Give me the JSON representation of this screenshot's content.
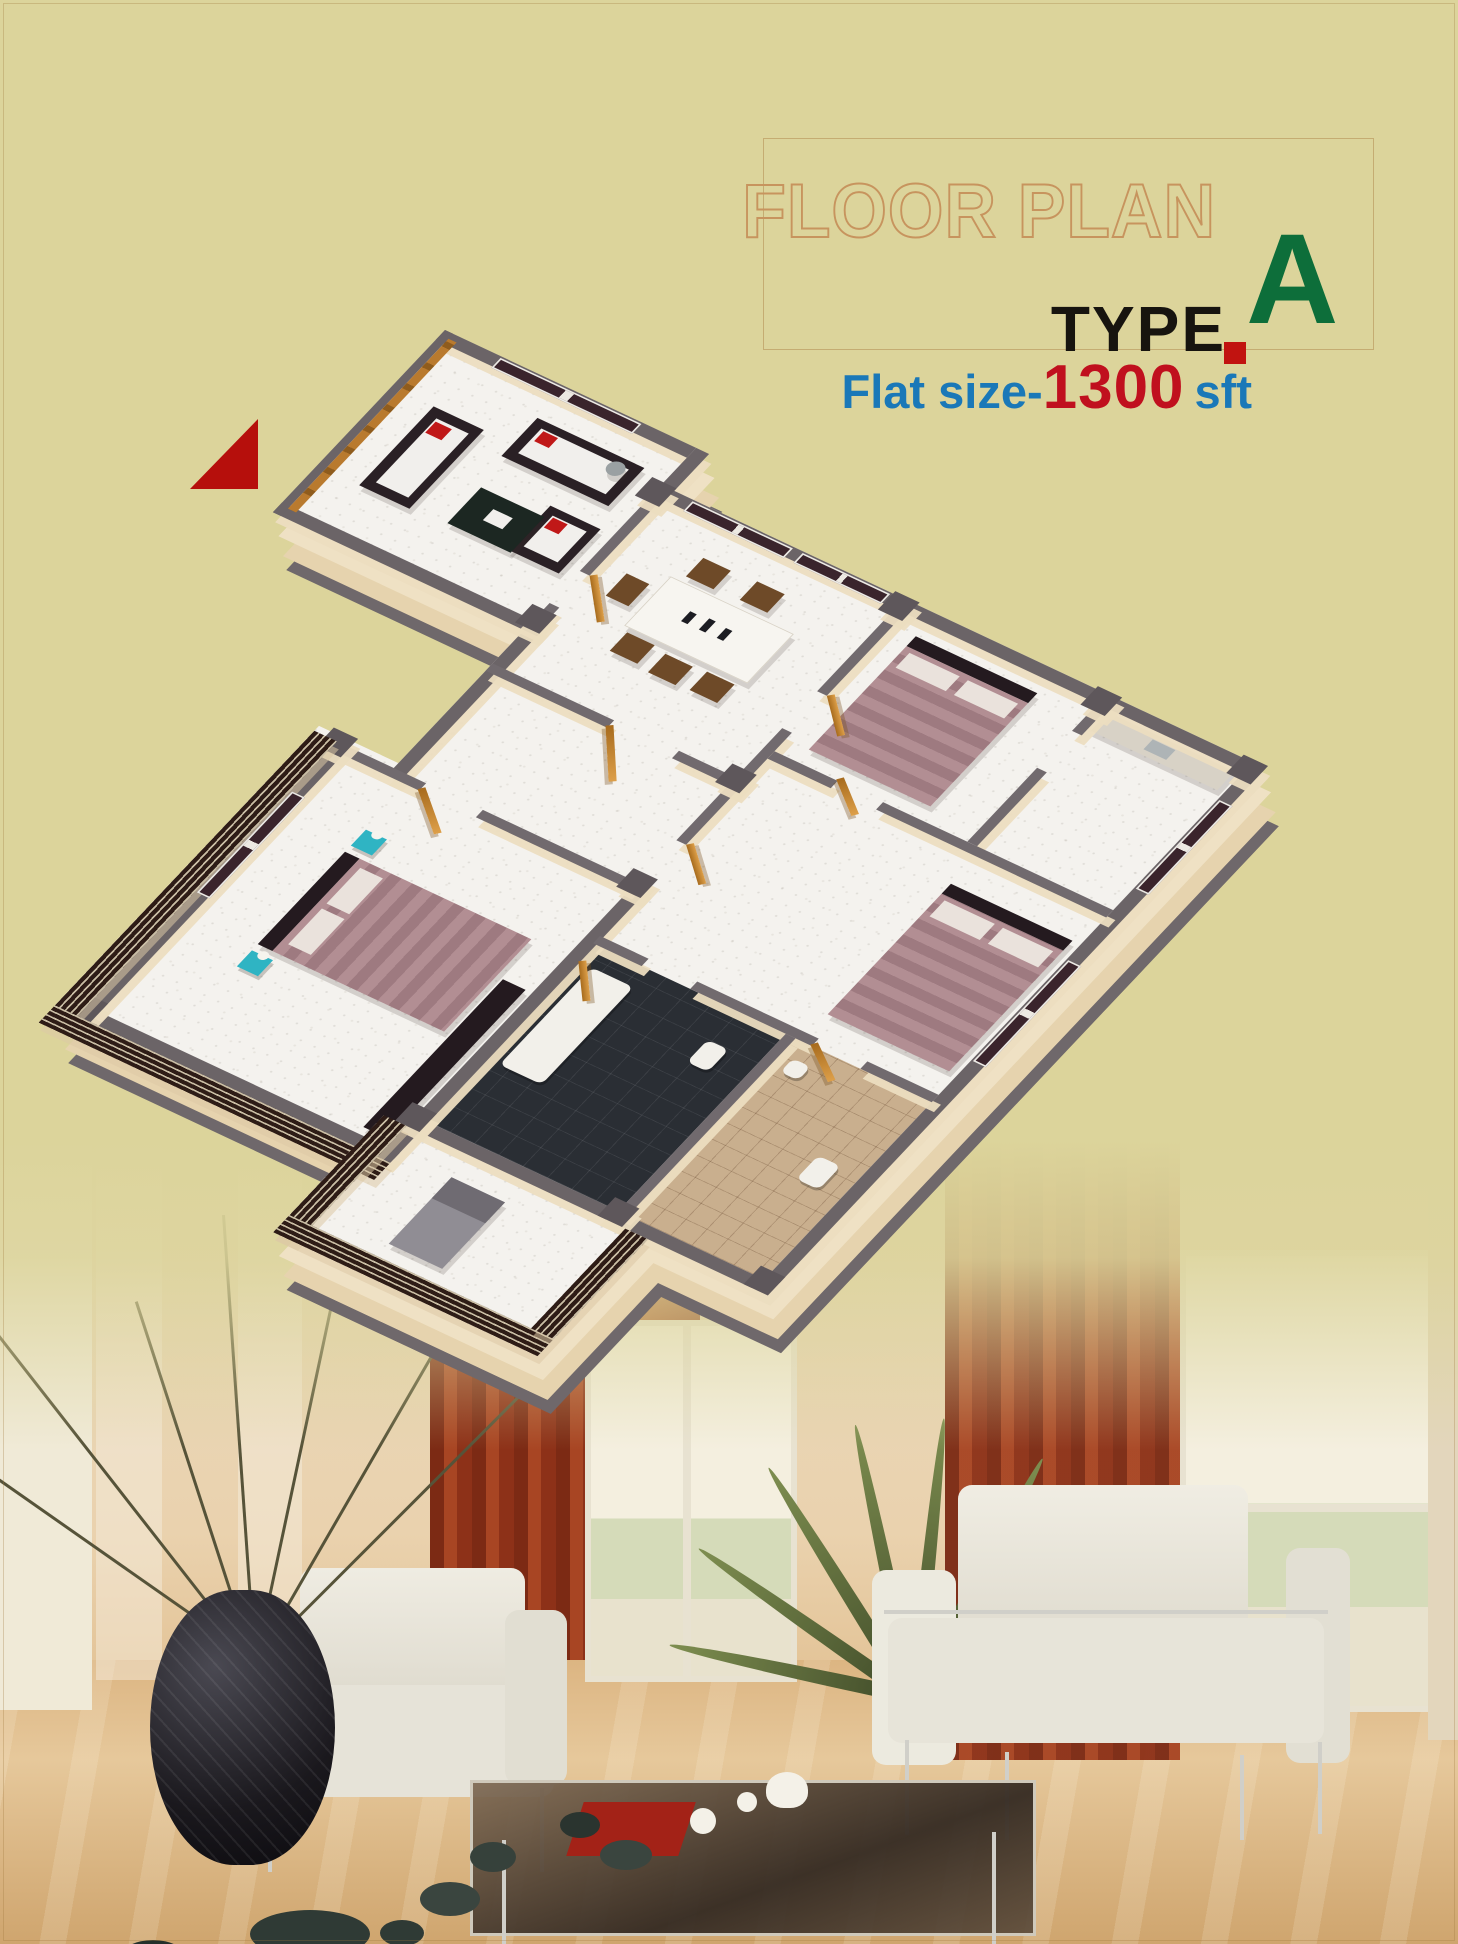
{
  "header": {
    "title": "FLOOR PLAN",
    "type_label": "TYPE",
    "type_value": "A",
    "flat_size_label": "Flat size-",
    "flat_size_value": "1300",
    "flat_size_unit": "sft"
  },
  "colors": {
    "background_khaki": "#dcd49b",
    "title_outline": "#c7945e",
    "type_text": "#17140f",
    "type_value_green": "#0d6e3a",
    "accent_red_square": "#c11310",
    "north_marker_red": "#b60f0c",
    "flat_size_blue": "#1a78b8",
    "flat_size_red": "#c0101e",
    "wall_cap_gray": "#6b6467",
    "wall_face_cream": "#efe1c4",
    "floor_marble_white": "#f4f2ee",
    "door_wood": "#c07f2a",
    "window_glass_dark": "#3a242c",
    "bed_mauve": "#b28e93",
    "sofa_dark": "#2a2025",
    "teal_nightstand": "#2fb4c3",
    "louver_dark": "#2e1c16",
    "photo_floor_tan": "#dcb582",
    "curtain_red": "#8d3118"
  },
  "north_marker": {
    "shape": "red-right-triangle",
    "color": "#b60f0c"
  },
  "floor_plan": {
    "projection": "3d-isometric-render",
    "rooms": [
      "living-room",
      "dining-room",
      "bedroom-3",
      "kitchen",
      "bedroom-2",
      "bathroom-1",
      "bathroom-2",
      "master-bedroom",
      "hall",
      "living-veranda",
      "master-balcony"
    ],
    "furniture": [
      "sofa-set-with-red-pillows",
      "coffee-table",
      "dining-table-with-chairs",
      "double-beds-mauve",
      "teal-nightstands-with-lamps",
      "wardrobe",
      "toilet-fixtures",
      "balcony-recliner",
      "wooden-doors",
      "dark-glass-windows",
      "louvered-balcony-walls"
    ]
  },
  "photo_scene": {
    "items": [
      "black-vase-with-dry-branches",
      "pebbles",
      "cream-armchair-left",
      "cream-armchair-right",
      "glass-coffee-table",
      "tea-set",
      "red-mat",
      "red-curtains",
      "window-left",
      "window-right",
      "palm-plant",
      "glossy-beige-floor"
    ]
  }
}
